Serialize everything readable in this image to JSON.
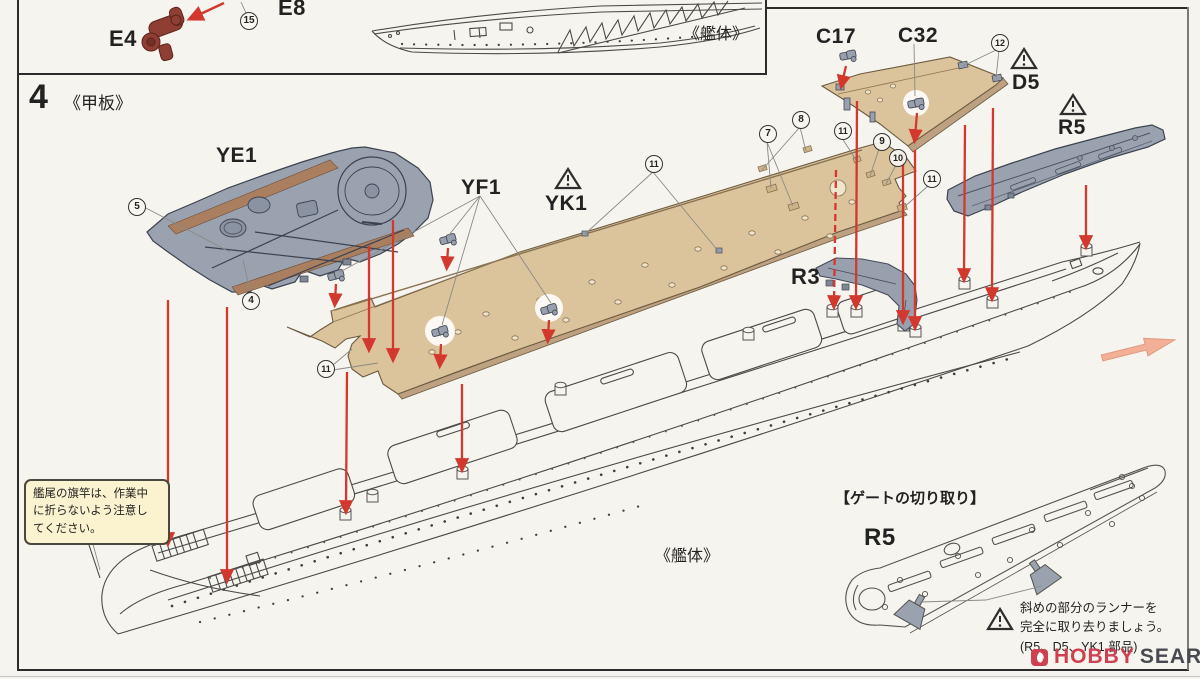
{
  "prev_panel": {
    "part_e4": "E4",
    "part_e8": "E8",
    "hull_label": "《艦体》"
  },
  "step": {
    "number": "4",
    "title": "《甲板》"
  },
  "labels": {
    "ye1": "YE1",
    "yf1": "YF1",
    "yk1": "YK1",
    "c17": "C17",
    "c32": "C32",
    "d5": "D5",
    "r5": "R5",
    "r3": "R3",
    "hull": "《艦体》"
  },
  "callouts": {
    "n4": "4",
    "n5": "5",
    "n7": "7",
    "n8": "8",
    "n9": "9",
    "n10": "10",
    "n11": "11",
    "n12": "12",
    "n15": "15"
  },
  "stern_note": {
    "line1": "艦尾の旗竿は、作業中",
    "line2": "に折らないよう注意し",
    "line3": "てください。"
  },
  "gate_section": {
    "title": "【ゲートの切り取り】",
    "part": "R5",
    "note_line1": "斜めの部分のランナーを",
    "note_line2": "完全に取り去りましょう。",
    "note_line3": "(R5、D5、YK1 部品)"
  },
  "watermark": {
    "brand1": "HOBBY",
    "brand2": "SEARCH"
  },
  "colors": {
    "deck_tan": "#dbc39b",
    "part_gray": "#98a0ae",
    "arrow_red": "#d3382e",
    "guide_salmon": "#f3b096",
    "logo_red": "#cf4050"
  }
}
